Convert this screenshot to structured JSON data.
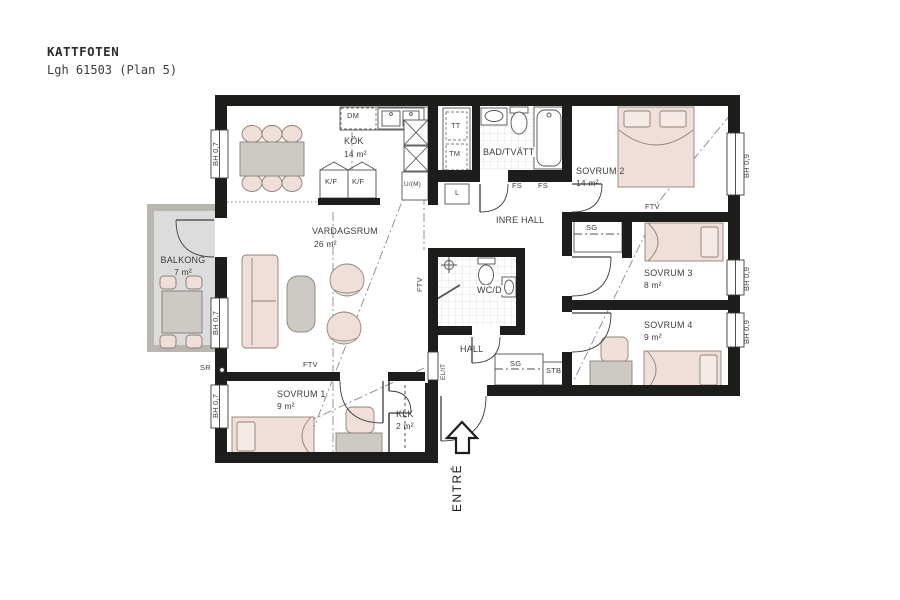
{
  "header": {
    "title": "KATTFOTEN",
    "subtitle": "Lgh 61503 (Plan 5)"
  },
  "rooms": {
    "kok": {
      "label": "KÖK",
      "area": "14 m²"
    },
    "vardagsrum": {
      "label": "VARDAGSRUM",
      "area": "26 m²"
    },
    "balkong": {
      "label": "BALKONG",
      "area": "7 m²"
    },
    "bad_tvatt": {
      "label": "BAD/TVÄTT"
    },
    "inre_hall": {
      "label": "INRE HALL"
    },
    "wc_d": {
      "label": "WC/D"
    },
    "hall": {
      "label": "HALL"
    },
    "klk": {
      "label": "KLK",
      "area": "2 m²"
    },
    "sovrum1": {
      "label": "SOVRUM 1",
      "area": "9 m²"
    },
    "sovrum2": {
      "label": "SOVRUM 2",
      "area": "14 m²"
    },
    "sovrum3": {
      "label": "SOVRUM 3",
      "area": "8 m²"
    },
    "sovrum4": {
      "label": "SOVRUM 4",
      "area": "9 m²"
    }
  },
  "fixtures": {
    "dm": "DM",
    "kf": "K/F",
    "um": "U/(M)",
    "tt": "TT",
    "tm": "TM",
    "l": "L",
    "fs": "FS",
    "sg": "SG",
    "stb": "STB",
    "el_it": "EL/IT",
    "sr": "SR",
    "ftv": "FTV"
  },
  "windows": {
    "bh_07": "BH 0,7",
    "bh_09": "BH 0,9"
  },
  "entrance": {
    "label": "ENTRÉ"
  },
  "colors": {
    "wall": "#1d1d1b",
    "furniture_pink": "#f0ded9",
    "furniture_gray": "#cdc9c4",
    "balcony_floor": "#dcdcdc",
    "text": "#3c3c3a"
  }
}
